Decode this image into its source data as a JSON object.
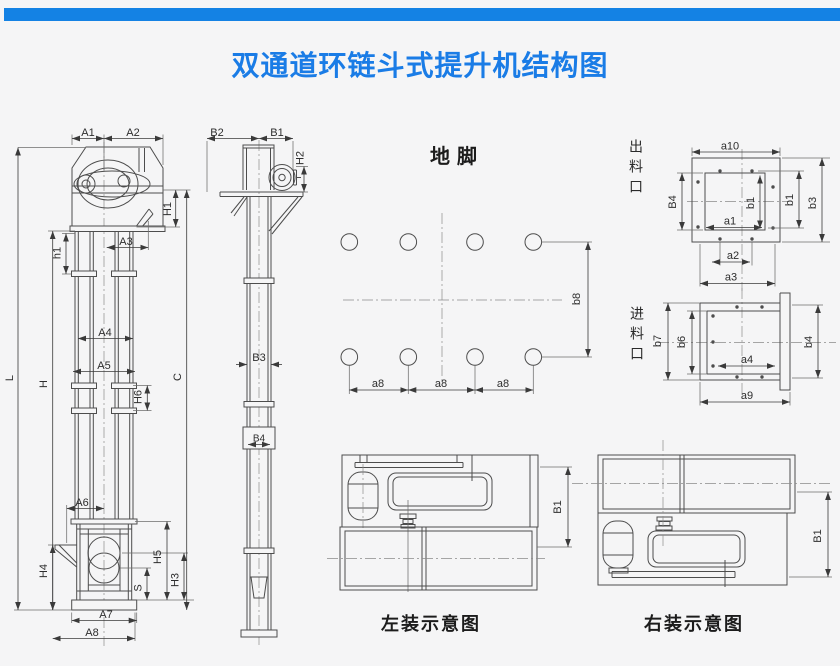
{
  "page": {
    "title": "双通道环链斗式提升机结构图",
    "title_color": "#1a7ce6",
    "bar_color": "#1482e4",
    "background": "#f5f5f6",
    "line_color": "#4d4d4d"
  },
  "captions": {
    "foundation": "地脚",
    "discharge_port": "出料口",
    "feed_port": "进料口",
    "left_install": "左装示意图",
    "right_install": "右装示意图"
  },
  "dims": {
    "A1": "A1",
    "A2": "A2",
    "A3": "A3",
    "A4": "A4",
    "A5": "A5",
    "A6": "A6",
    "A7": "A7",
    "A8": "A8",
    "h1": "h1",
    "H1": "H1",
    "H2": "H2",
    "H3": "H3",
    "H4": "H4",
    "H5": "H5",
    "H6": "H6",
    "L": "L",
    "H": "H",
    "C": "C",
    "S": "S",
    "B1": "B1",
    "B2": "B2",
    "B3": "B3",
    "B4": "B4",
    "a1": "a1",
    "a2": "a2",
    "a3": "a3",
    "a4": "a4",
    "a8": "a8",
    "a9": "a9",
    "a10": "a10",
    "b1": "b1",
    "b3": "b3",
    "b4": "b4",
    "b6": "b6",
    "b7": "b7",
    "b8": "b8"
  }
}
